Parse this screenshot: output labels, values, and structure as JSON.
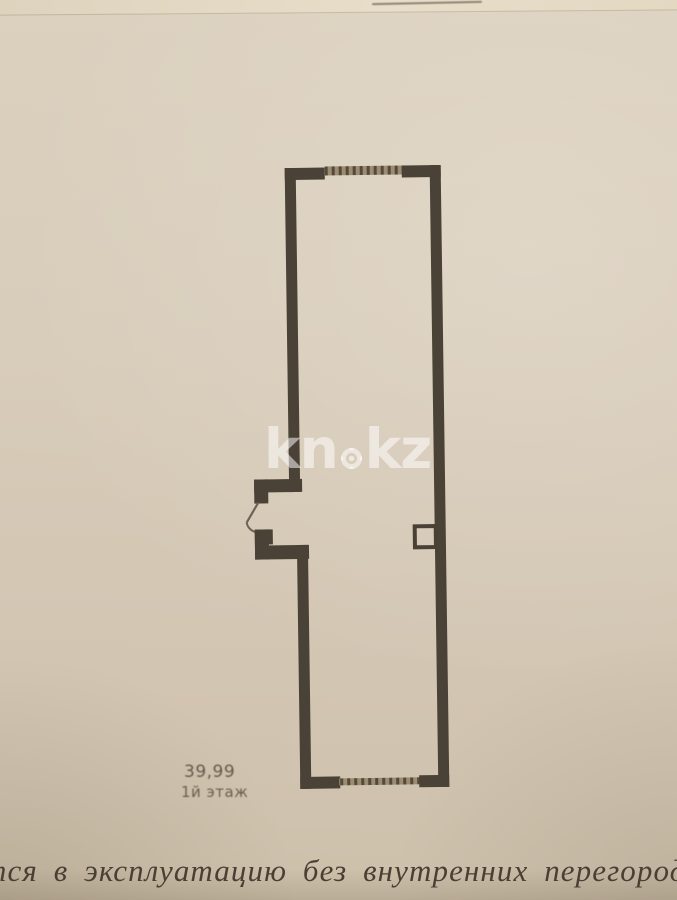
{
  "photo": {
    "watermark": {
      "part1": "kn",
      "part2": "kz",
      "full": "kn.kz",
      "color": "#ffffff"
    },
    "floor_plan": {
      "area_label": "39,99",
      "floor_label": "1й этаж",
      "wall_color": "#4b4237",
      "window_band_color": "#9b8c72",
      "door_line_color": "#6f6354"
    },
    "caption_text": "тся в эксплуатацию без внутренних перегород",
    "paper_color": "#d5c9b7"
  }
}
